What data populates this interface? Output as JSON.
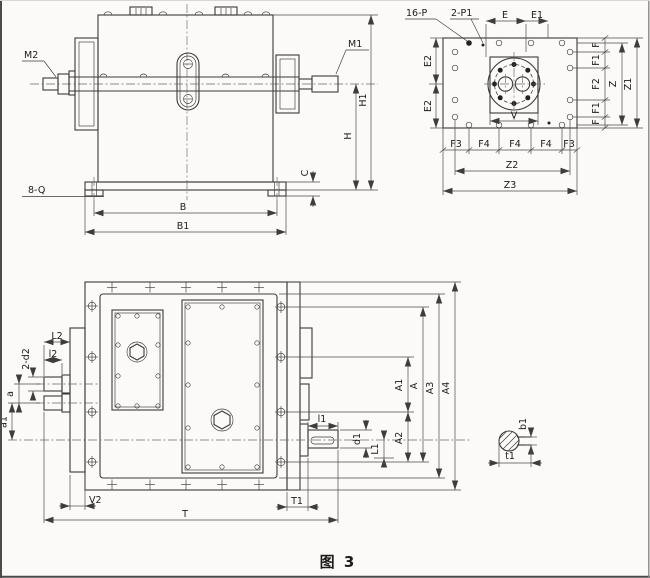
{
  "figure": {
    "caption": "图 3"
  },
  "colors": {
    "paper": "#fbfaf8",
    "line": "#3a3a3a",
    "dim": "#4b4b4b"
  },
  "labels": {
    "side": {
      "m2": "M2",
      "m1": "M1",
      "h1": "H1",
      "h": "H",
      "c": "C",
      "q": "8-Q",
      "b": "B",
      "b1": "B1"
    },
    "flange": {
      "p": "16-P",
      "p1": "2-P1",
      "e": "E",
      "e1": "E1",
      "e2": "E2",
      "f": "F",
      "f1": "F1",
      "f2": "F2",
      "z": "Z",
      "z1": "Z1",
      "v": "V",
      "f3": "F3",
      "f4": "F4",
      "z2": "Z2",
      "z3": "Z3"
    },
    "plan": {
      "L2": "L2",
      "l2": "l2",
      "d2": "2-d2",
      "a": "a",
      "a1": "a1",
      "v2": "V2",
      "t": "T",
      "t1": "T1",
      "l1": "l1",
      "d1": "d1",
      "L1": "L1",
      "A1": "A1",
      "A": "A",
      "A2": "A2",
      "A3": "A3",
      "A4": "A4"
    },
    "key": {
      "b1": "b1",
      "t1": "t1"
    }
  }
}
